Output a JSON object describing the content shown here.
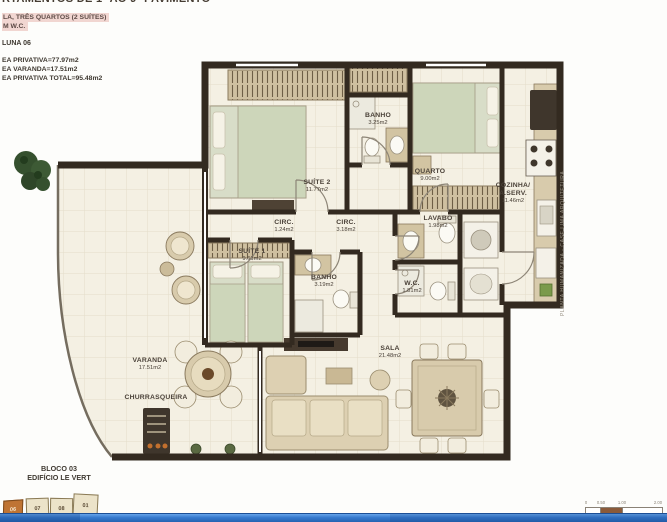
{
  "header": {
    "title_clipped": "RTAMENTOS DE 1º AO 9º PAVIMENTO",
    "highlight_line1": "LA, TRÊS QUARTOS (2 SUÍTES)",
    "highlight_line2": "M W.C.",
    "column": "LUNA 06",
    "area_lines": [
      "EA PRIVATIVA=77.97m2",
      "EA VARANDA=17.51m2",
      "EA PRIVATIVA TOTAL=95.48m2"
    ]
  },
  "plan": {
    "rooms": [
      {
        "name": "SUÍTE 2",
        "area": "11.77m2"
      },
      {
        "name": "BANHO",
        "area": "3.25m2"
      },
      {
        "name": "QUARTO",
        "area": "9.00m2"
      },
      {
        "name": "COZINHA/",
        "name2": "A.SERV.",
        "area": "11.46m2"
      },
      {
        "name": "CIRC.",
        "area": "1.24m2"
      },
      {
        "name": "CIRC.",
        "area": "3.18m2"
      },
      {
        "name": "LAVABO",
        "area": "1.98m2"
      },
      {
        "name": "SUÍTE 1",
        "area": "9.61m2"
      },
      {
        "name": "BANHO",
        "area": "3.19m2"
      },
      {
        "name": "W.C.",
        "area": "1.81m2"
      },
      {
        "name": "SALA",
        "area": "21.48m2"
      },
      {
        "name": "VARANDA",
        "area": "17.51m2"
      },
      {
        "name": "CHURRASQUEIRA",
        "area": ""
      }
    ],
    "watermark": "PLANTA HUMANIZADA - CASE LIMA ARQUITETURA"
  },
  "footer": {
    "bloco": "BLOCO 03",
    "edificio": "EDIFÍCIO LE VERT",
    "site_units": [
      "06",
      "07",
      "08",
      "01"
    ]
  },
  "scalebar": {
    "ticks": [
      "0",
      "0.50",
      "1.00",
      "2.00"
    ]
  },
  "colors": {
    "highlight_pink": "#f1d6d1",
    "wall_dark": "#332a20",
    "floor_cream": "#f4f0e3",
    "site_orange": "#bf7434",
    "bar_blue": "#3579cd"
  }
}
